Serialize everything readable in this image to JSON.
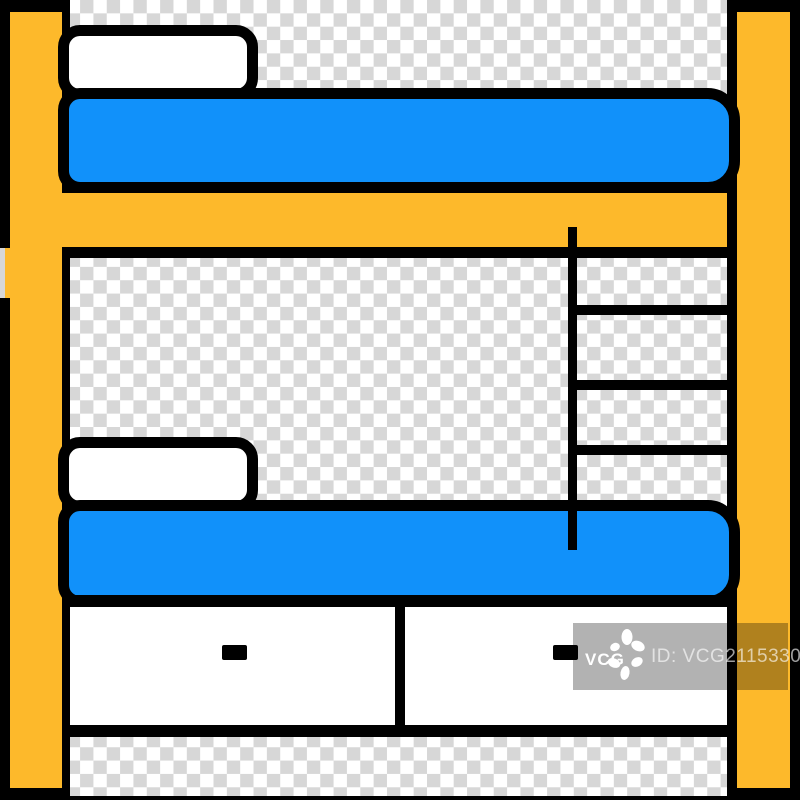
{
  "image": {
    "title": "bunk bed color icon",
    "background_style": "transparency checkerboard"
  },
  "colors": {
    "frame_yellow": "#FDB92B",
    "mattress_blue": "#1191FA",
    "outline_black": "#000000",
    "pillow_white": "#FFFFFF",
    "checker_gray": "#D7D7D7",
    "checker_white": "#FFFFFF",
    "watermark_overlay": "rgba(0,0,0,0.30)",
    "watermark_text": "rgba(255,255,255,0.62)"
  },
  "watermark": {
    "logo_text": "VCG",
    "logo_icon": "vcg-pinwheel-icon",
    "id_text": "ID: VCG211533028746"
  }
}
